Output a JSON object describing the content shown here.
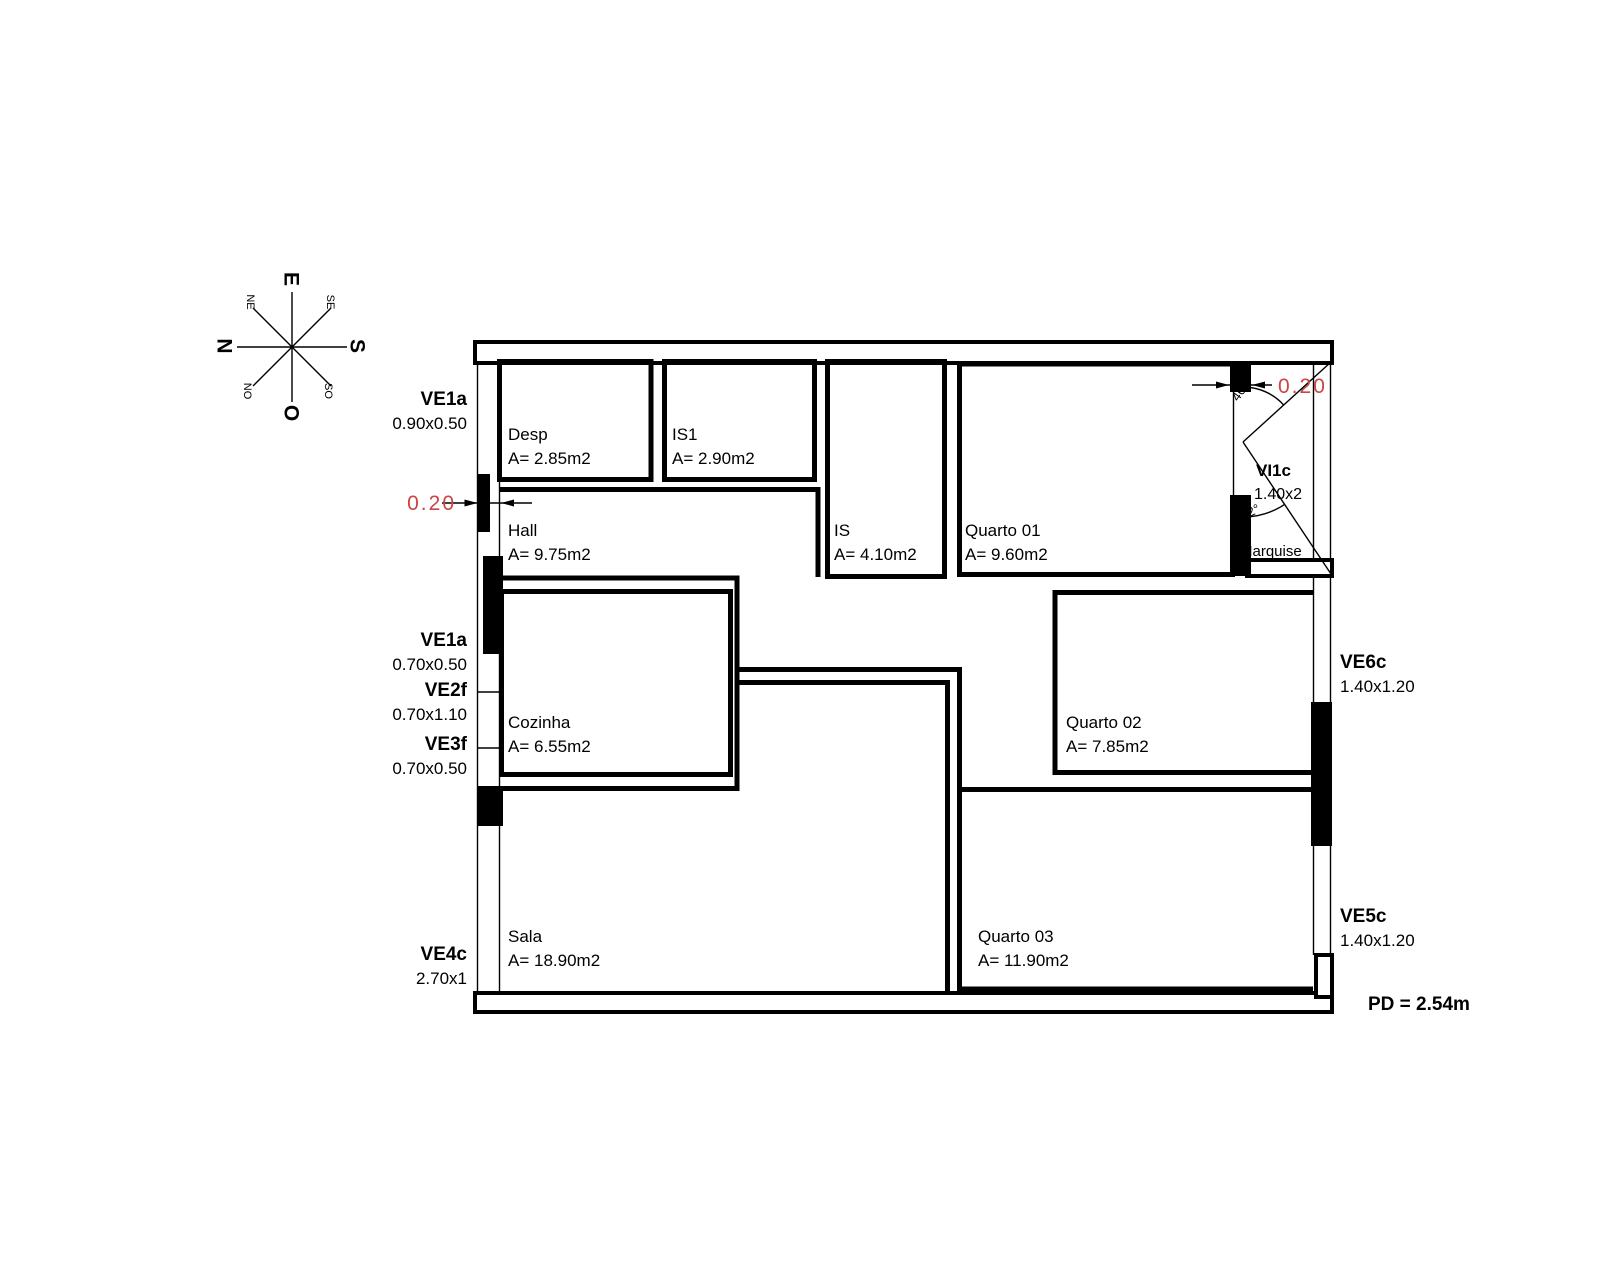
{
  "compass": {
    "cardinals": [
      {
        "label": "E"
      },
      {
        "label": "N"
      },
      {
        "label": "S"
      },
      {
        "label": "O"
      }
    ],
    "intercardinals": [
      {
        "label": "NE"
      },
      {
        "label": "SE"
      },
      {
        "label": "NO"
      },
      {
        "label": "SO"
      }
    ]
  },
  "rooms": [
    {
      "name": "Desp",
      "area": "A= 2.85m2"
    },
    {
      "name": "IS1",
      "area": "A= 2.90m2"
    },
    {
      "name": "IS",
      "area": "A= 4.10m2"
    },
    {
      "name": "Quarto 01",
      "area": "A= 9.60m2"
    },
    {
      "name": "Hall",
      "area": "A= 9.75m2"
    },
    {
      "name": "Cozinha",
      "area": "A= 6.55m2"
    },
    {
      "name": "Quarto 02",
      "area": "A= 7.85m2"
    },
    {
      "name": "Sala",
      "area": "A= 18.90m2"
    },
    {
      "name": "Quarto 03",
      "area": "A= 11.90m2"
    },
    {
      "name": "Marquise",
      "area": ""
    }
  ],
  "openings_left": [
    {
      "code": "VE1a",
      "size": "0.90x0.50"
    },
    {
      "code": "VE1a",
      "size": "0.70x0.50"
    },
    {
      "code": "VE2f",
      "size": "0.70x1.10"
    },
    {
      "code": "VE3f",
      "size": "0.70x0.50"
    },
    {
      "code": "VE4c",
      "size": "2.70x1"
    }
  ],
  "openings_right": [
    {
      "code": "VE6c",
      "size": "1.40x1.20"
    },
    {
      "code": "VE5c",
      "size": "1.40x1.20"
    }
  ],
  "internal_window": {
    "code": "VI1c",
    "size": "1.40x2"
  },
  "dimensions": {
    "wall_left": "0.20",
    "wall_right": "0.20",
    "angle_upper": "46°",
    "angle_lower": "32°"
  },
  "notes": {
    "ceiling_height": "PD = 2.54m"
  },
  "colors": {
    "ink": "#000000",
    "dimension_red": "#cc4444"
  }
}
